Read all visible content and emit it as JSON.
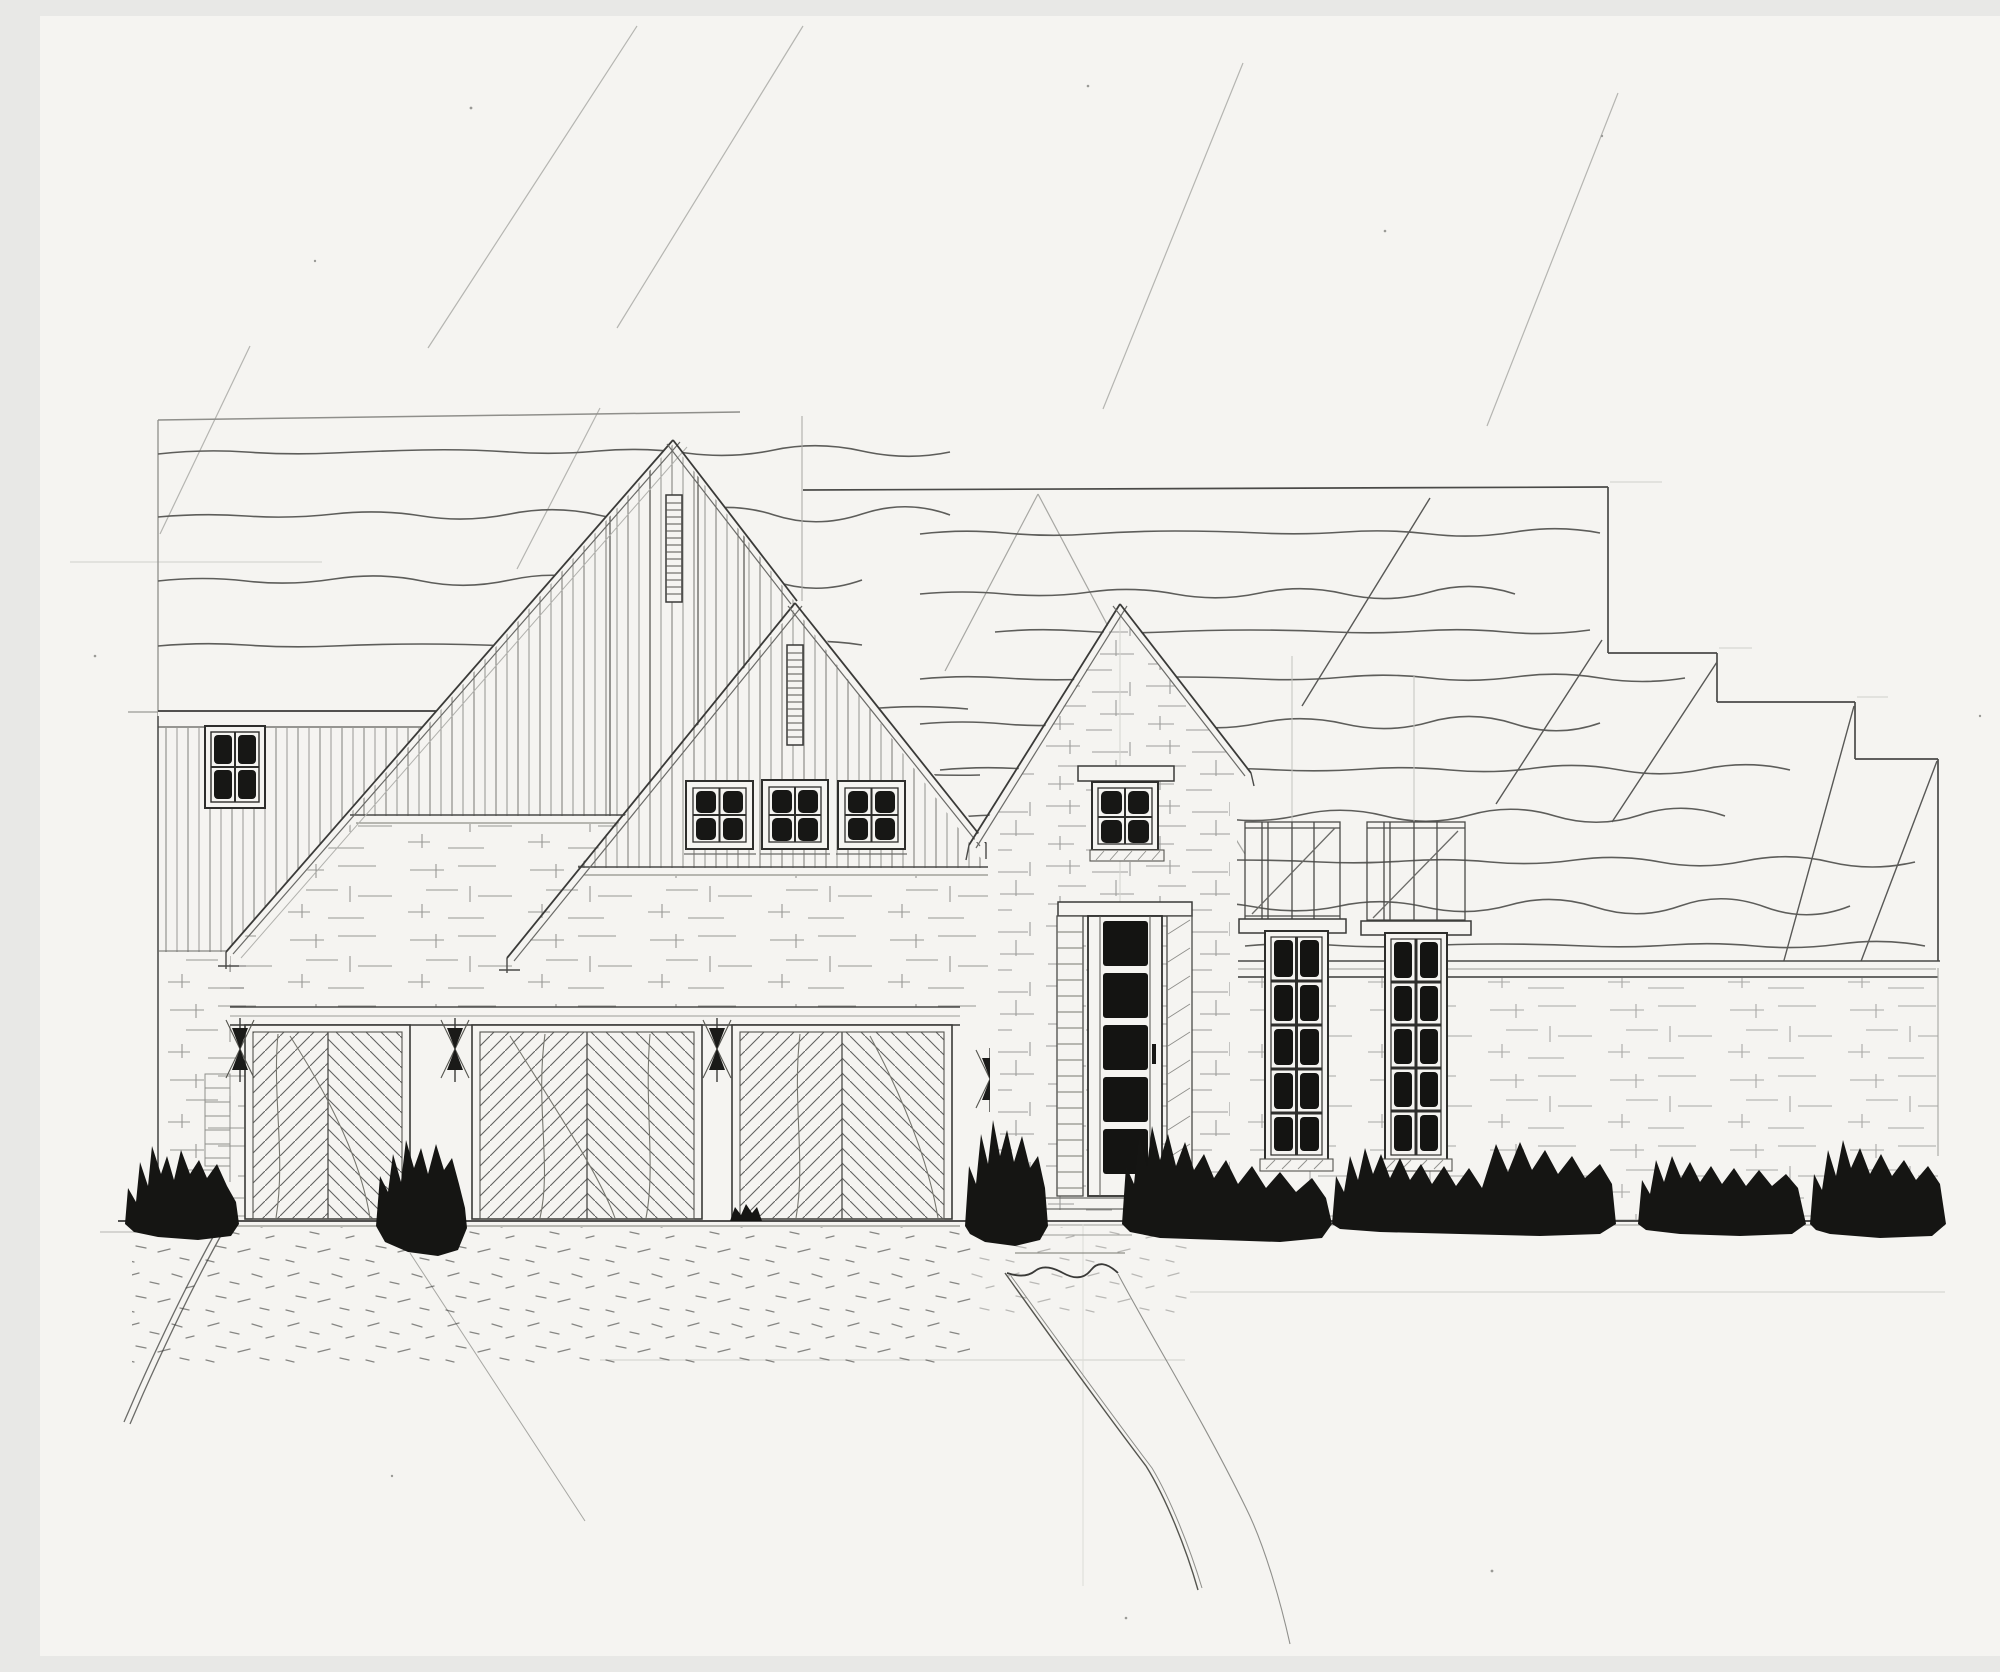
{
  "meta": {
    "title": "Hand-drawn front elevation sketch of a single-family house",
    "aria_label": "Pencil sketch on white paper: front elevation of a house with two steep gables clad in vertical board siding, a tall brick entry tower with a glass-paneled front door, three chevron-patterned garage doors, stepped roof planes descending to the right, two tall dark multi-pane windows on the brick right wing, and dark ink shrubs along the foundation with a stippled driveway and front walkway."
  },
  "palette": {
    "paper": "#f5f4f1",
    "pencil_faint": "#c9c9c4",
    "pencil_light": "#9b9b97",
    "pencil_mid": "#6b6b68",
    "pencil_dark": "#3a3a38",
    "ink_fill": "#171715"
  },
  "figure": {
    "garage_door_count": 3,
    "gable_window_count": 3,
    "door_glass_panel_count": 5,
    "tall_window_pane_rows": 5,
    "tall_window_pane_cols": 2,
    "attic_vent_count": 2,
    "wall_sconce_count": 4,
    "bush_cluster_count": 7
  }
}
